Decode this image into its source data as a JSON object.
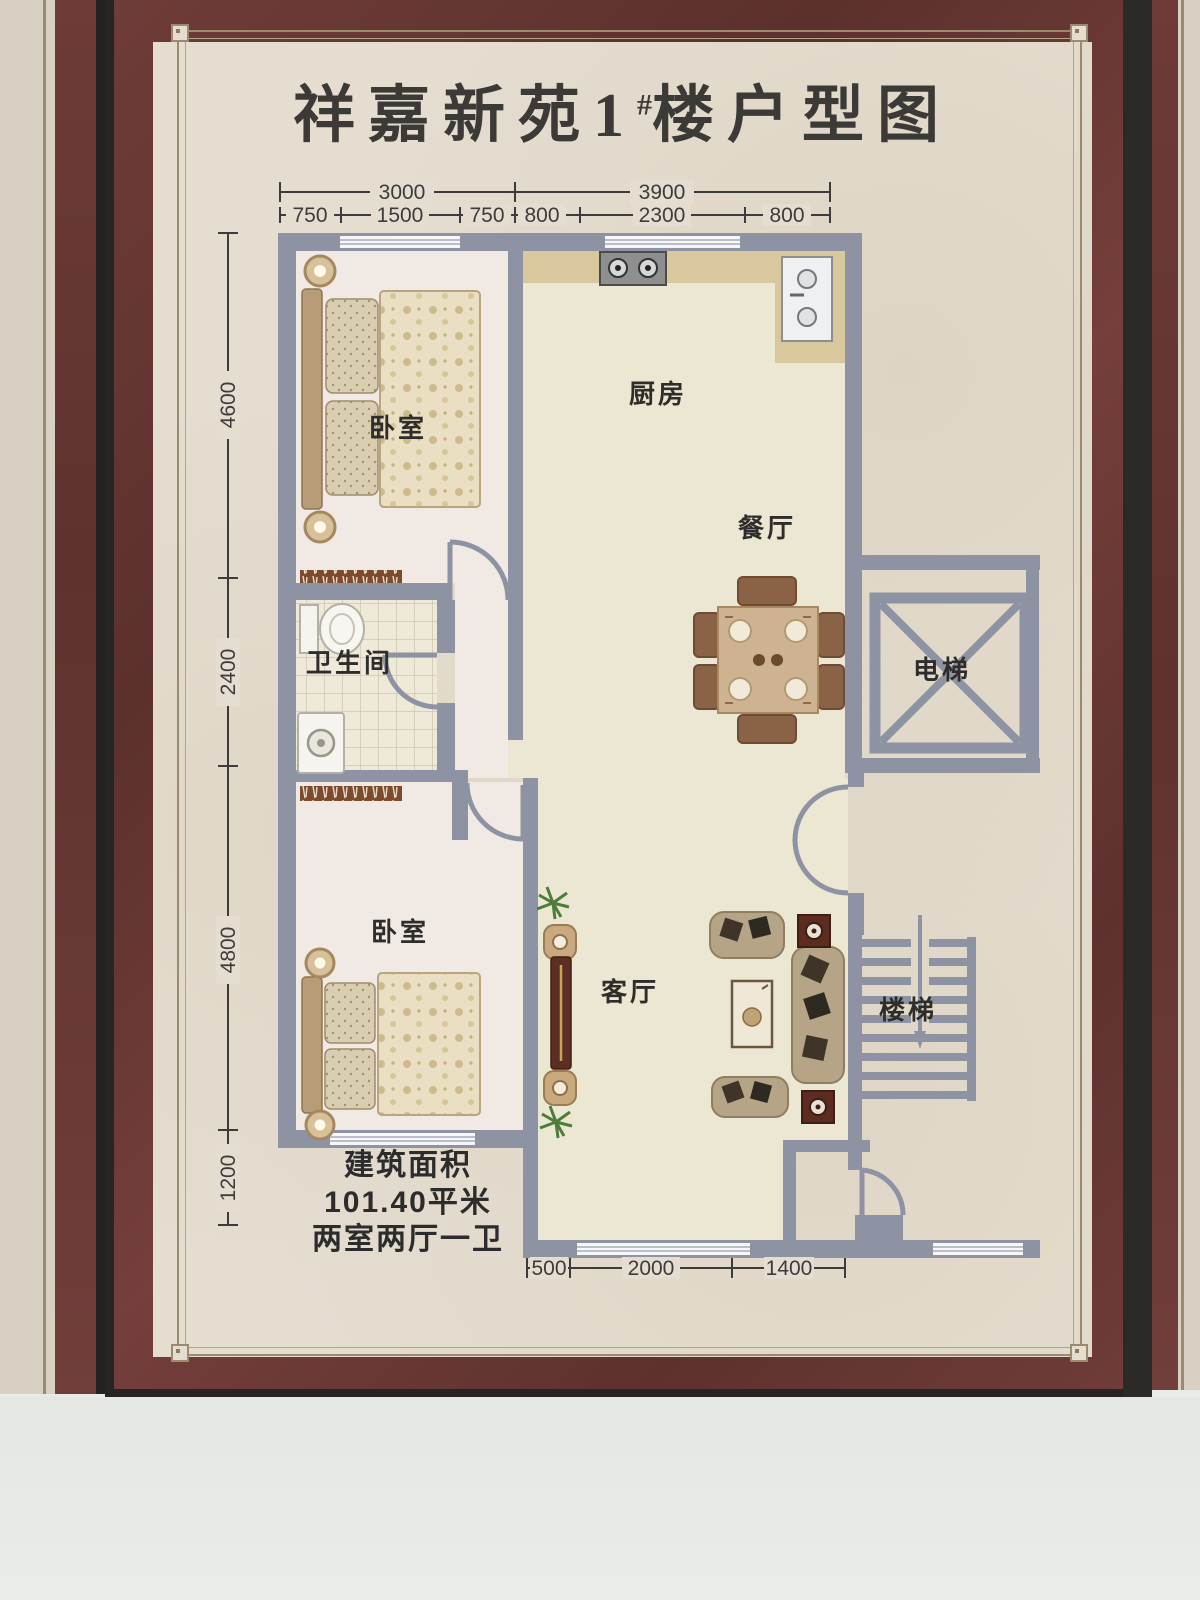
{
  "title": {
    "prefix": "祥嘉新苑",
    "number": "1",
    "hash": "#",
    "suffix": "楼户型图"
  },
  "rooms": {
    "bedroom_top": "卧室",
    "kitchen": "厨房",
    "dining": "餐厅",
    "bathroom": "卫生间",
    "elevator": "电梯",
    "bedroom_bottom": "卧室",
    "living": "客厅",
    "stairs": "楼梯"
  },
  "area": {
    "line1": "建筑面积",
    "line2": "101.40平米",
    "line3": "两室两厅一卫"
  },
  "dimensions": {
    "top_overall": [
      "3000",
      "3900"
    ],
    "top_detail": [
      "750",
      "1500",
      "750",
      "800",
      "2300",
      "800"
    ],
    "left": [
      "4600",
      "2400",
      "4800",
      "1200"
    ],
    "bottom": [
      "500",
      "2000",
      "1400"
    ]
  },
  "colors": {
    "frame_maroon": "#6d3a36",
    "frame_black": "#262522",
    "mat_paper": "#e4ddd0",
    "plan_wall": "#8e93a4",
    "floor_main": "#ebe7d2",
    "floor_bedroom": "#f1eae4",
    "counter_tan": "#d9c79e",
    "dim_text": "#3c3c3c",
    "background_wall": "#e9ebe7"
  }
}
